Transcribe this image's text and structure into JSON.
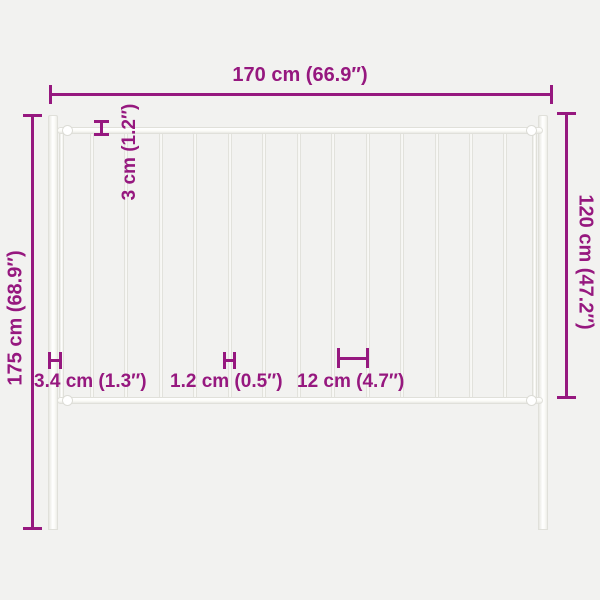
{
  "diagram": {
    "type": "product-dimension-diagram",
    "subject": "white steel fence panel with two ground posts",
    "background_color": "#f2f2f0",
    "accent_color": "#96187f",
    "fence_color": "#ffffff",
    "fence_border_color": "#e0e0da",
    "fence": {
      "picket_count": 13,
      "first_picket_x": 90,
      "picket_spacing": 34.45
    },
    "dimensions": {
      "total_width": "170 cm (66.9″)",
      "post_height": "175 cm (68.9″)",
      "panel_height": "120 cm (47.2″)",
      "rail_thickness": "3 cm (1.2″)",
      "post_width": "3.4 cm (1.3″)",
      "picket_width": "1.2 cm (0.5″)",
      "picket_gap": "12 cm (4.7″)"
    }
  }
}
